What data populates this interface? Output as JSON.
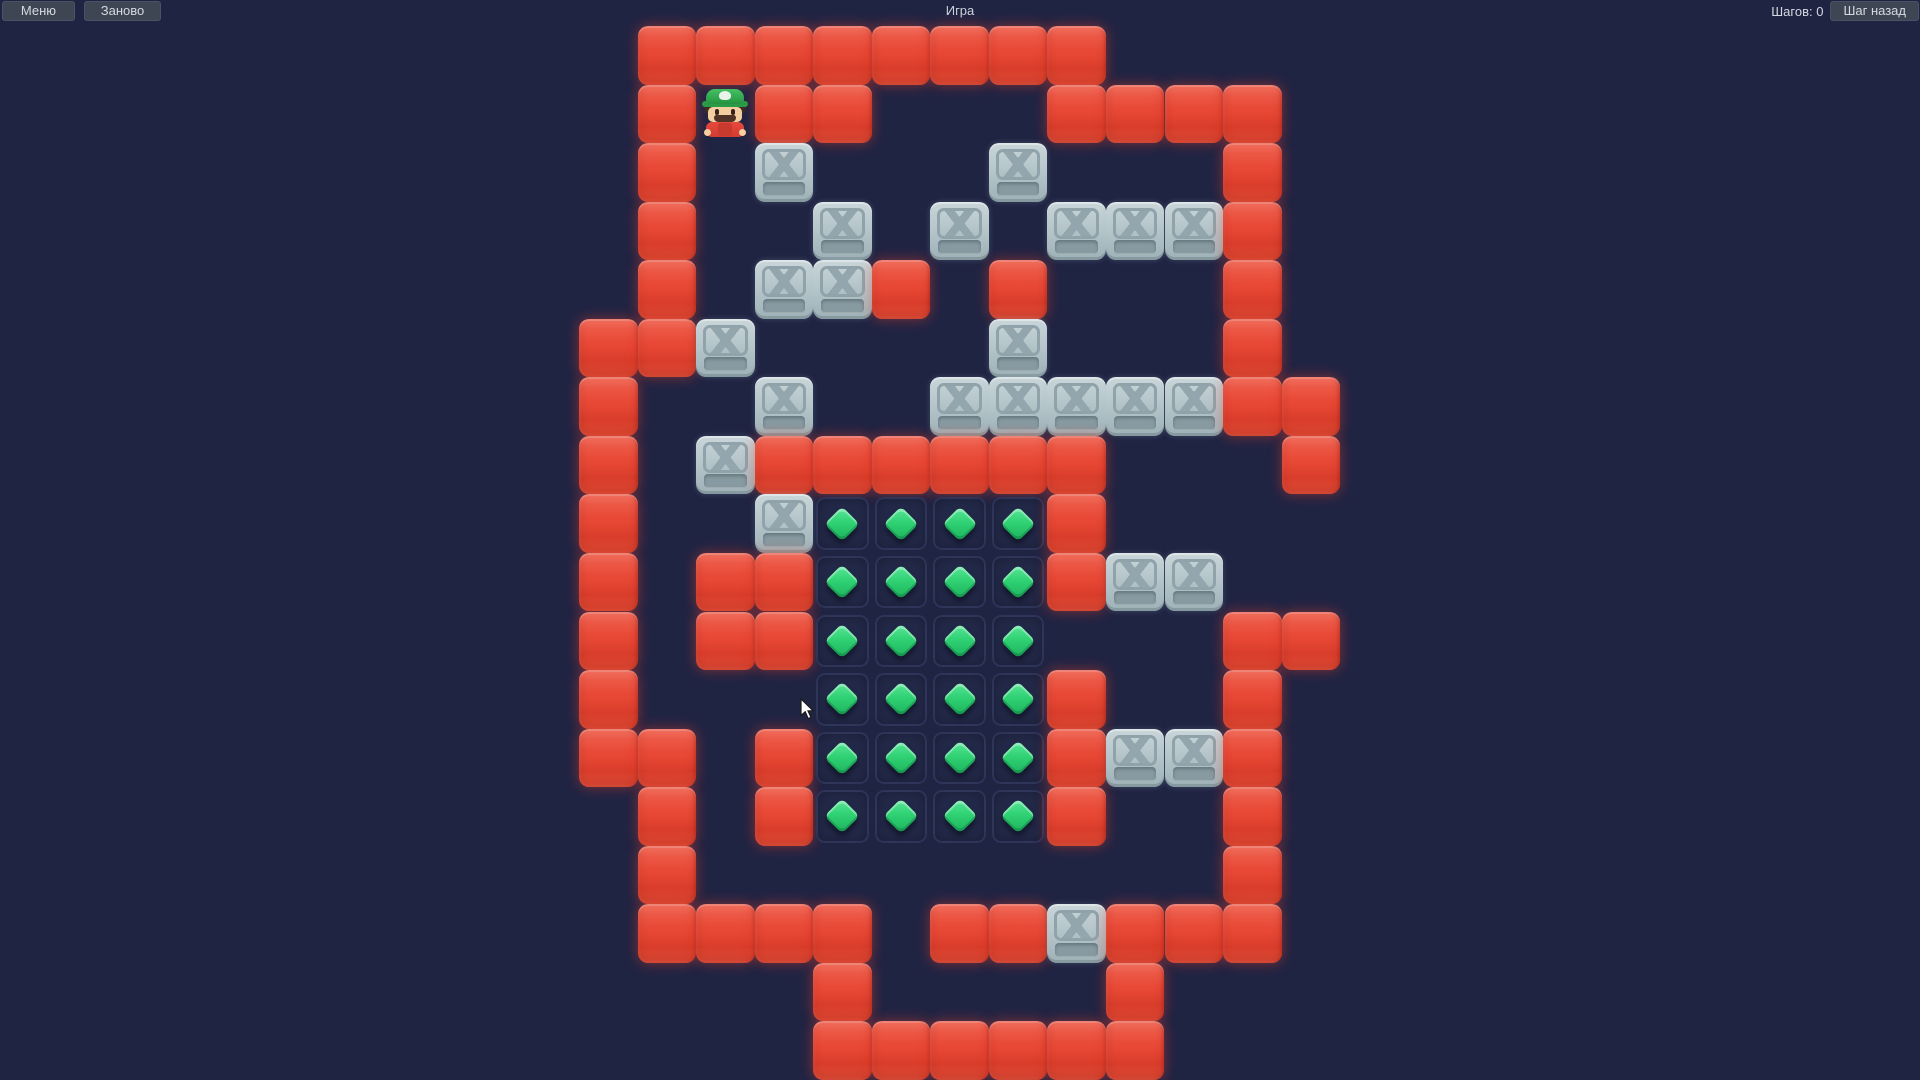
{
  "app": {
    "title": "Игра"
  },
  "toolbar": {
    "menu_label": "Меню",
    "restart_label": "Заново",
    "steps_label": "Шагов: 0",
    "undo_label": "Шаг назад"
  },
  "board": {
    "cols": 13,
    "rows": 18,
    "cell_px": 58.55,
    "origin_x": 579,
    "origin_y": 26,
    "legend": {
      "R": "red-wall-block",
      "C": "steel-crate",
      "G": "gem-tile",
      "P": "player",
      ".": "empty"
    },
    "grid": [
      ".RRRRRRRR....",
      ".RPRR...RRRR.",
      ".R.C...C...R.",
      ".R..C.C.CCCR.",
      ".R.CCR.R...R.",
      "RRC....C...R.",
      "R..C..CCCCCRR",
      "R.CRRRRRR...R",
      "R..CGGGGR....",
      "R.RRGGGGRCC..",
      "R.RRGGGG...RR",
      "R...GGGGR..R.",
      "RR.RGGGGRCCR.",
      ".R.RGGGGR..R.",
      ".R.........R.",
      ".RRRR.RRCRRR.",
      "....R....R...",
      "....RRRRRR..."
    ],
    "gem_count": 24,
    "crate_count": 24
  },
  "cursor": {
    "x": 800,
    "y": 698
  },
  "colors": {
    "background": "#202443",
    "wall_red": "#e64634",
    "crate_gray": "#b6c5ca",
    "gem_green": "#2fd173",
    "button_bg": "#3e4654",
    "button_text": "#d5dae1"
  }
}
